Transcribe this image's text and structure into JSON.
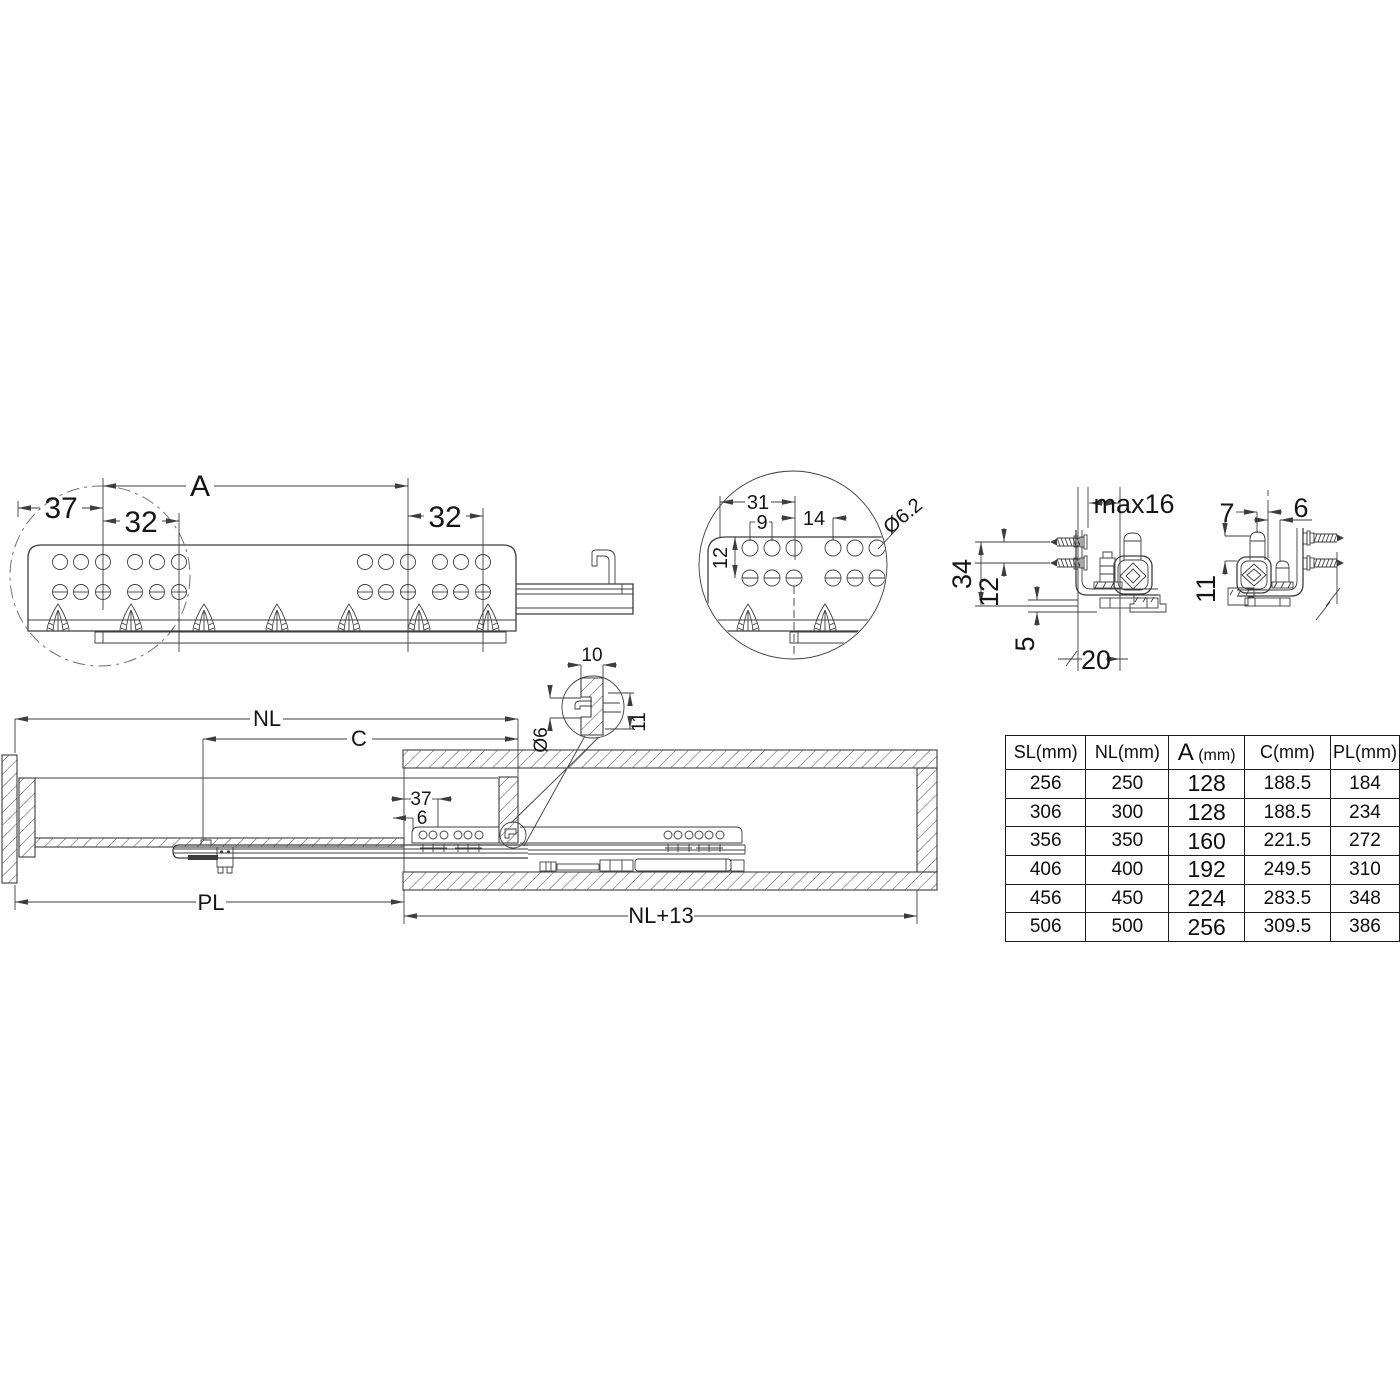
{
  "page": {
    "background": "#ffffff",
    "line_color": "#3d3d3d",
    "text_color": "#141414"
  },
  "views": {
    "rail_side_view": {
      "dims": {
        "A": "A",
        "d37": "37",
        "d32_left": "32",
        "d32_right": "32"
      }
    },
    "hole_pattern_detail": {
      "dims": {
        "d31": "31",
        "d9": "9",
        "d14": "14",
        "d12": "12",
        "dia62": "Ø6.2"
      }
    },
    "cross_section_left": {
      "dims": {
        "max16": "max16",
        "d34": "34",
        "d12": "12",
        "d5": "5",
        "d20": "20"
      }
    },
    "cross_section_right": {
      "dims": {
        "d7": "7",
        "d6": "6",
        "d11": "11"
      }
    },
    "installation_view": {
      "dims": {
        "NL": "NL",
        "C": "C",
        "PL": "PL",
        "NL13": "NL+13",
        "d37": "37",
        "d6": "6"
      }
    },
    "hook_detail": {
      "dims": {
        "d10": "10",
        "dia6": "Ø6",
        "d11": "11"
      }
    }
  },
  "spec_table": {
    "headers": [
      "SL(mm)",
      "NL(mm)",
      "A (mm)",
      "C(mm)",
      "PL(mm)"
    ],
    "rows": [
      [
        "256",
        "250",
        "128",
        "188.5",
        "184"
      ],
      [
        "306",
        "300",
        "128",
        "188.5",
        "234"
      ],
      [
        "356",
        "350",
        "160",
        "221.5",
        "272"
      ],
      [
        "406",
        "400",
        "192",
        "249.5",
        "310"
      ],
      [
        "456",
        "450",
        "224",
        "283.5",
        "348"
      ],
      [
        "506",
        "500",
        "256",
        "309.5",
        "386"
      ]
    ]
  }
}
